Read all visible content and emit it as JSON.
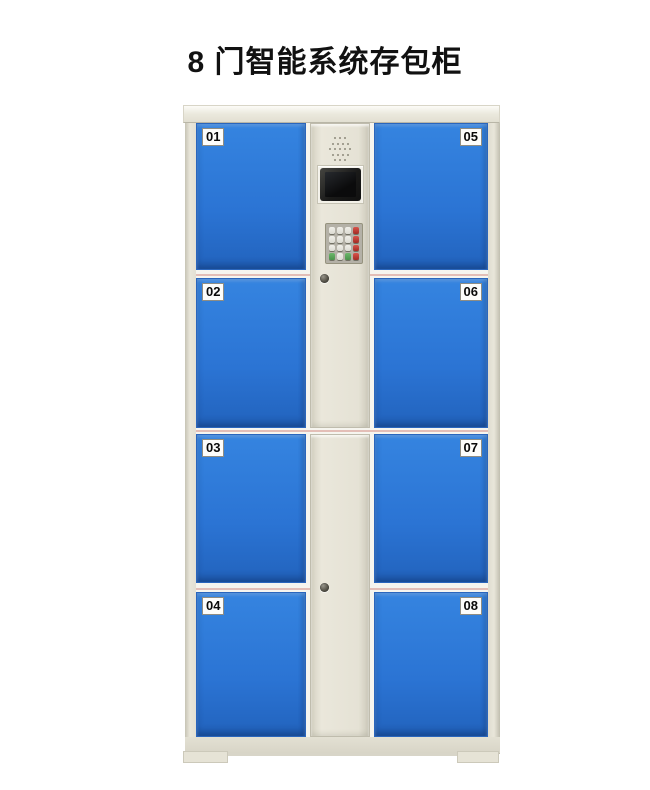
{
  "title": "8 门智能系统存包柜",
  "locker": {
    "doors": {
      "left": [
        "01",
        "02",
        "03",
        "04"
      ],
      "right": [
        "05",
        "06",
        "07",
        "08"
      ]
    },
    "control_panel": {
      "components": [
        "speaker-grille",
        "lcd-display",
        "keypad",
        "cam-lock"
      ],
      "keypad": {
        "rows": 4,
        "cols": 4
      }
    },
    "colors": {
      "door_blue": "#2B74D4",
      "frame_beige": "#E6E3D7",
      "keypad_red": "#B23129",
      "keypad_green": "#58A258",
      "background": "#FFFFFF"
    }
  }
}
